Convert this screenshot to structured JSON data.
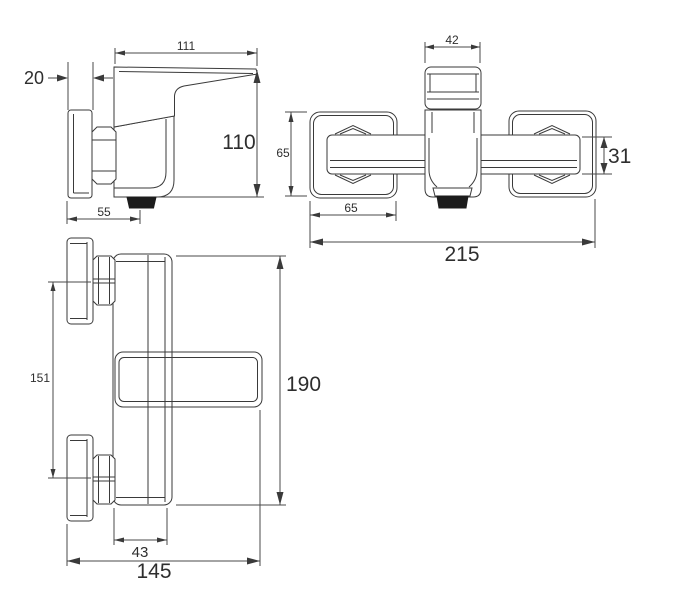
{
  "views": {
    "side_view": {
      "name": "side profile view",
      "labels": {
        "top_width": "111",
        "plate_thickness": "20",
        "height": "110",
        "base_depth": "55"
      }
    },
    "front_view": {
      "name": "front view",
      "labels": {
        "handle_width": "42",
        "escutcheon_height": "65",
        "body_depth": "31",
        "escutcheon_width": "65",
        "total_width": "215"
      }
    },
    "plan_view": {
      "name": "plan view",
      "labels": {
        "connection_spacing": "151",
        "total_length": "190",
        "body_width": "43",
        "total_projection": "145"
      }
    }
  }
}
